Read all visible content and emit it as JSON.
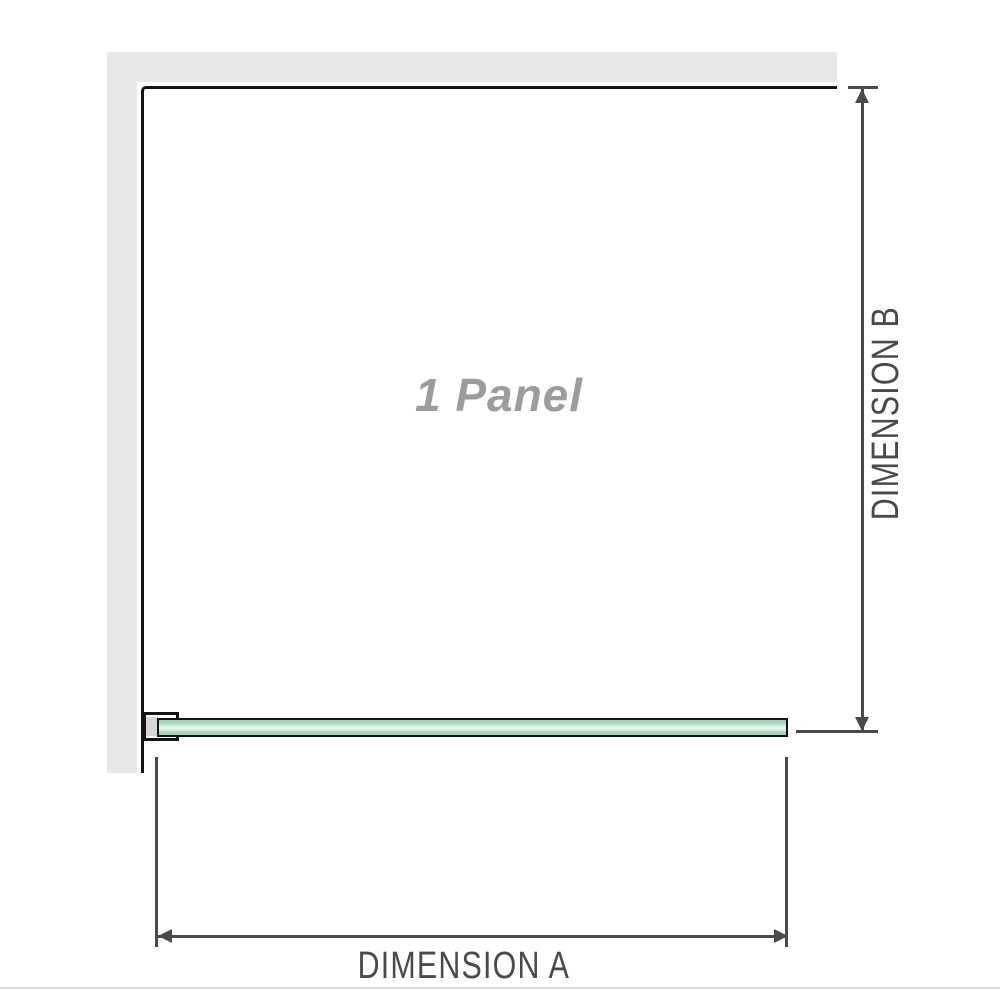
{
  "diagram": {
    "panel_label": "1 Panel",
    "dimension_a_label": "DIMENSION A",
    "dimension_b_label": "DIMENSION B"
  },
  "colors": {
    "wall_gray": "#e8e8e8",
    "outline_black": "#141414",
    "dimension_gray": "#4a4a4a",
    "glass_green": "#aeddc2",
    "glass_green_deep": "#9cd2b4",
    "glass_highlight": "#e9f6ee",
    "panel_label_gray": "#9c9c9c",
    "shim_gray": "#d6d6d6",
    "divider_gray": "#dbdbd7"
  }
}
